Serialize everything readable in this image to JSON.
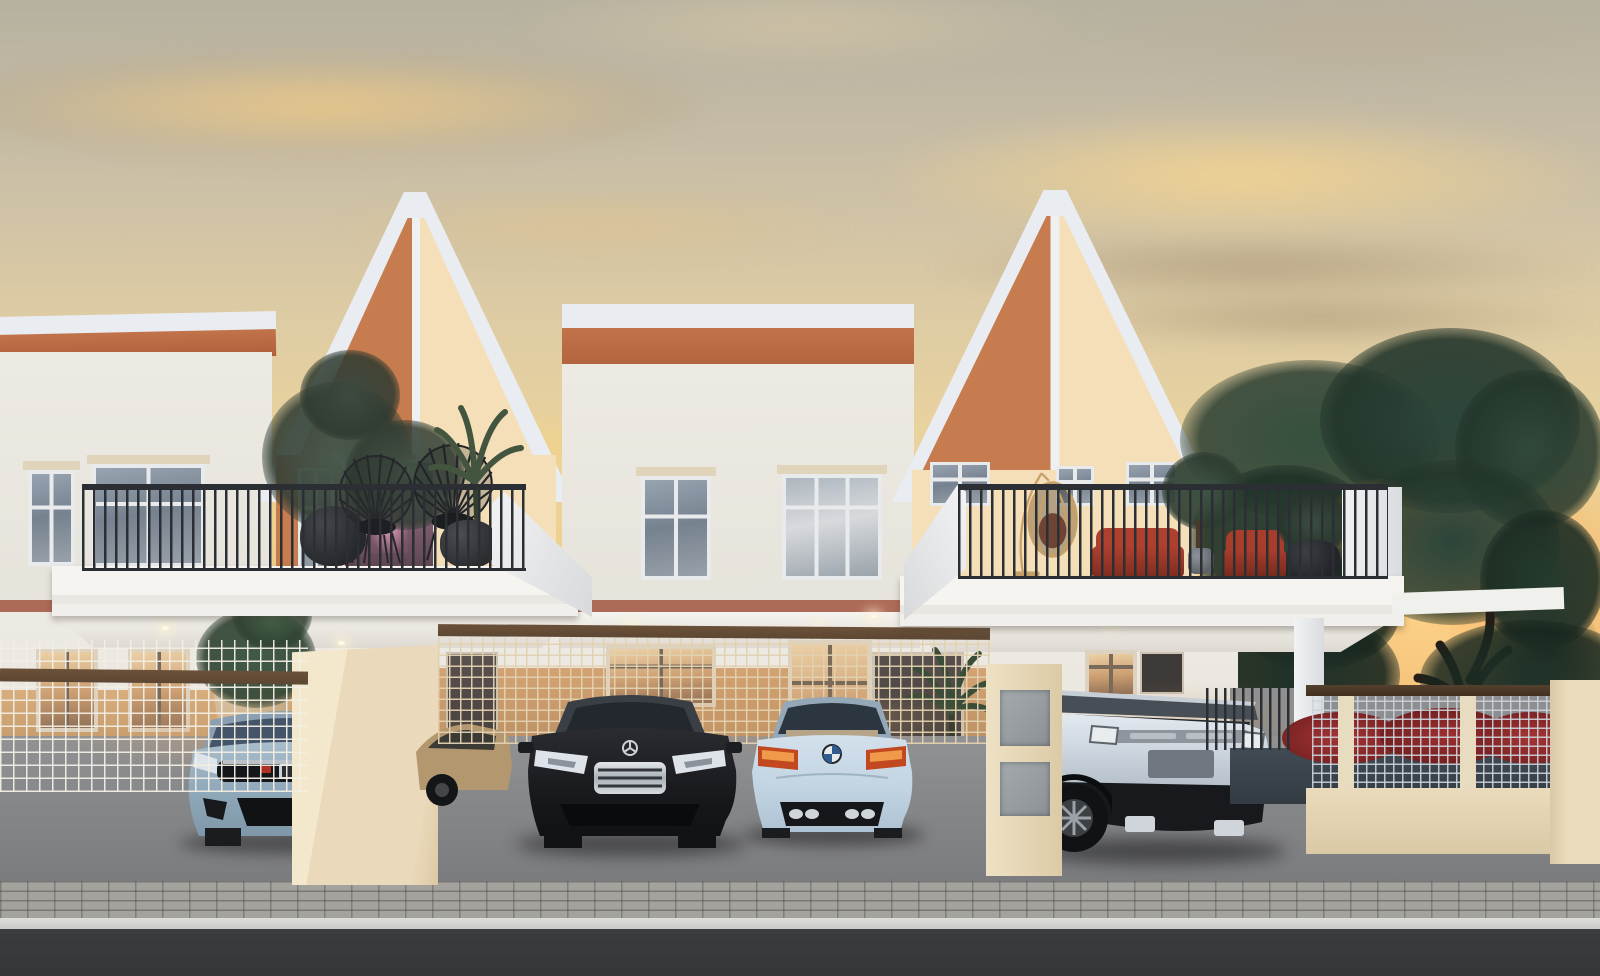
{
  "scene": {
    "description": "Photorealistic dusk rendering of a row of modern two-storey terraced houses with white-framed gable facades in terracotta and cream, balconies with plants and wire chairs, carports with four luxury cars, mesh fences, a red flowering hedge and a large tree backlit by a golden sunset sky",
    "time_of_day": "dusk / sunset",
    "houses": {
      "style": "modern minimalist terraced townhouses",
      "visible_units": 3,
      "gable_panel_colors": [
        "terracotta-orange",
        "cream"
      ],
      "trim_color": "white",
      "accent_band": "muted terracotta"
    },
    "balconies": {
      "left": {
        "furniture": [
          "dark potted plants",
          "two black wire fan chairs",
          "palm plant"
        ]
      },
      "right": {
        "furniture": [
          "rattan hanging egg chair",
          "red lounge cushions",
          "potted tree",
          "dark potted plant"
        ]
      }
    },
    "vehicles": [
      {
        "id": "honda-civic",
        "name": "Light blue Honda Civic hatchback (front view)",
        "color": "#9db4c4",
        "view": "front"
      },
      {
        "id": "tan-sedan",
        "name": "Tan sedan parked behind mesh fence",
        "color": "#b3976f",
        "view": "rear three-quarter"
      },
      {
        "id": "mercedes-s-class",
        "name": "Black Mercedes-Benz S-Class sedan (front view)",
        "color": "#17171a",
        "view": "front"
      },
      {
        "id": "bmw-m4",
        "name": "Pale blue BMW M4 coupe (rear view)",
        "color": "#c9d9e8",
        "view": "rear"
      },
      {
        "id": "range-rover-evoque",
        "name": "Silver Range Rover Evoque SUV (rear view)",
        "color": "#d3dae2",
        "view": "rear three-quarter"
      }
    ],
    "landscape": {
      "tree": "large broadleaf tree with sunset glow through canopy",
      "hedge": "red flowering hedge behind silver mesh fence",
      "fences": [
        "white wire mesh at left porch",
        "tan wire mesh behind cars",
        "silver mesh with beige posts at right"
      ],
      "ground": [
        "concrete driveway",
        "grey paver sidewalk",
        "dark asphalt road"
      ]
    },
    "palette": {
      "sky-top": "#b6b1a0",
      "sky-mid": "#dcc9a2",
      "sky-gold": "#f0cc85",
      "sky-glow": "#ffd9a0",
      "wall-white": "#eae7e0",
      "trim-white": "#e9ecf1",
      "gable-orange": "#c67c4e",
      "gable-cream": "#f4dfb9",
      "soffit-orange": "#c1734a",
      "band-terracotta": "#ad6a58",
      "railing-dark": "#2b2e32",
      "deck-white": "#f2f1ed",
      "pillar-beige": "#ead9ba",
      "wood-rail": "#5d4733",
      "driveway": "#858688",
      "paver": "#a3a29d",
      "curb": "#c9cac8",
      "asphalt": "#343639",
      "tree-green": "#2e4636",
      "tree-green-dark": "#22352a",
      "glow-orange": "#f09a4e",
      "hedge-red": "#9e2f2f",
      "plant-green": "#42543f",
      "chair-red": "#b0402e",
      "egg-chair-tan": "#c8a06a"
    }
  }
}
